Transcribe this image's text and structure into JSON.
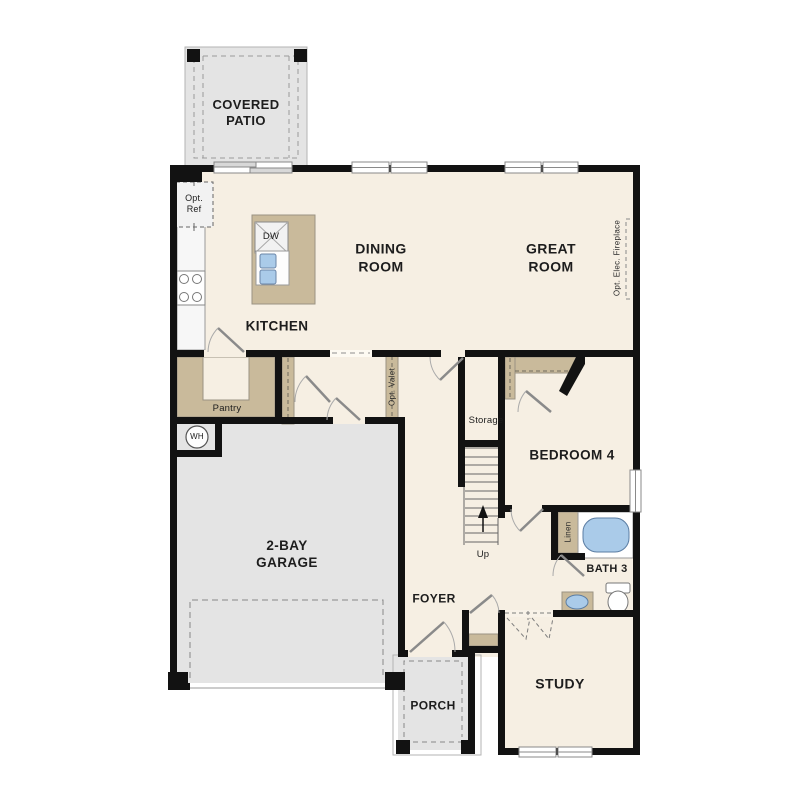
{
  "plan": {
    "title": "First floor residential floor plan",
    "rooms": {
      "covered_patio": "COVERED\nPATIO",
      "dining_room": "DINING\nROOM",
      "great_room": "GREAT\nROOM",
      "kitchen": "KITCHEN",
      "pantry": "Pantry",
      "storage": "Storage",
      "bedroom_4": "BEDROOM 4",
      "bath_3": "BATH 3",
      "garage": "2-BAY\nGARAGE",
      "foyer": "FOYER",
      "porch": "PORCH",
      "study": "STUDY"
    },
    "annotations": {
      "opt_ref": "Opt.\nRef",
      "opt_valet": "Opt. Valet",
      "opt_elec_fireplace": "Opt. Elec. Fireplace",
      "dishwasher": "DW",
      "water_heater": "WH",
      "linen": "Linen",
      "stairs_up": "Up"
    },
    "colors": {
      "floor": "#f6efe3",
      "concrete": "#e4e4e4",
      "wall": "#121212",
      "casework": "#c9ba9b",
      "water_fixture": "#aacbe9",
      "dashed_line": "#8f8f8f"
    }
  }
}
